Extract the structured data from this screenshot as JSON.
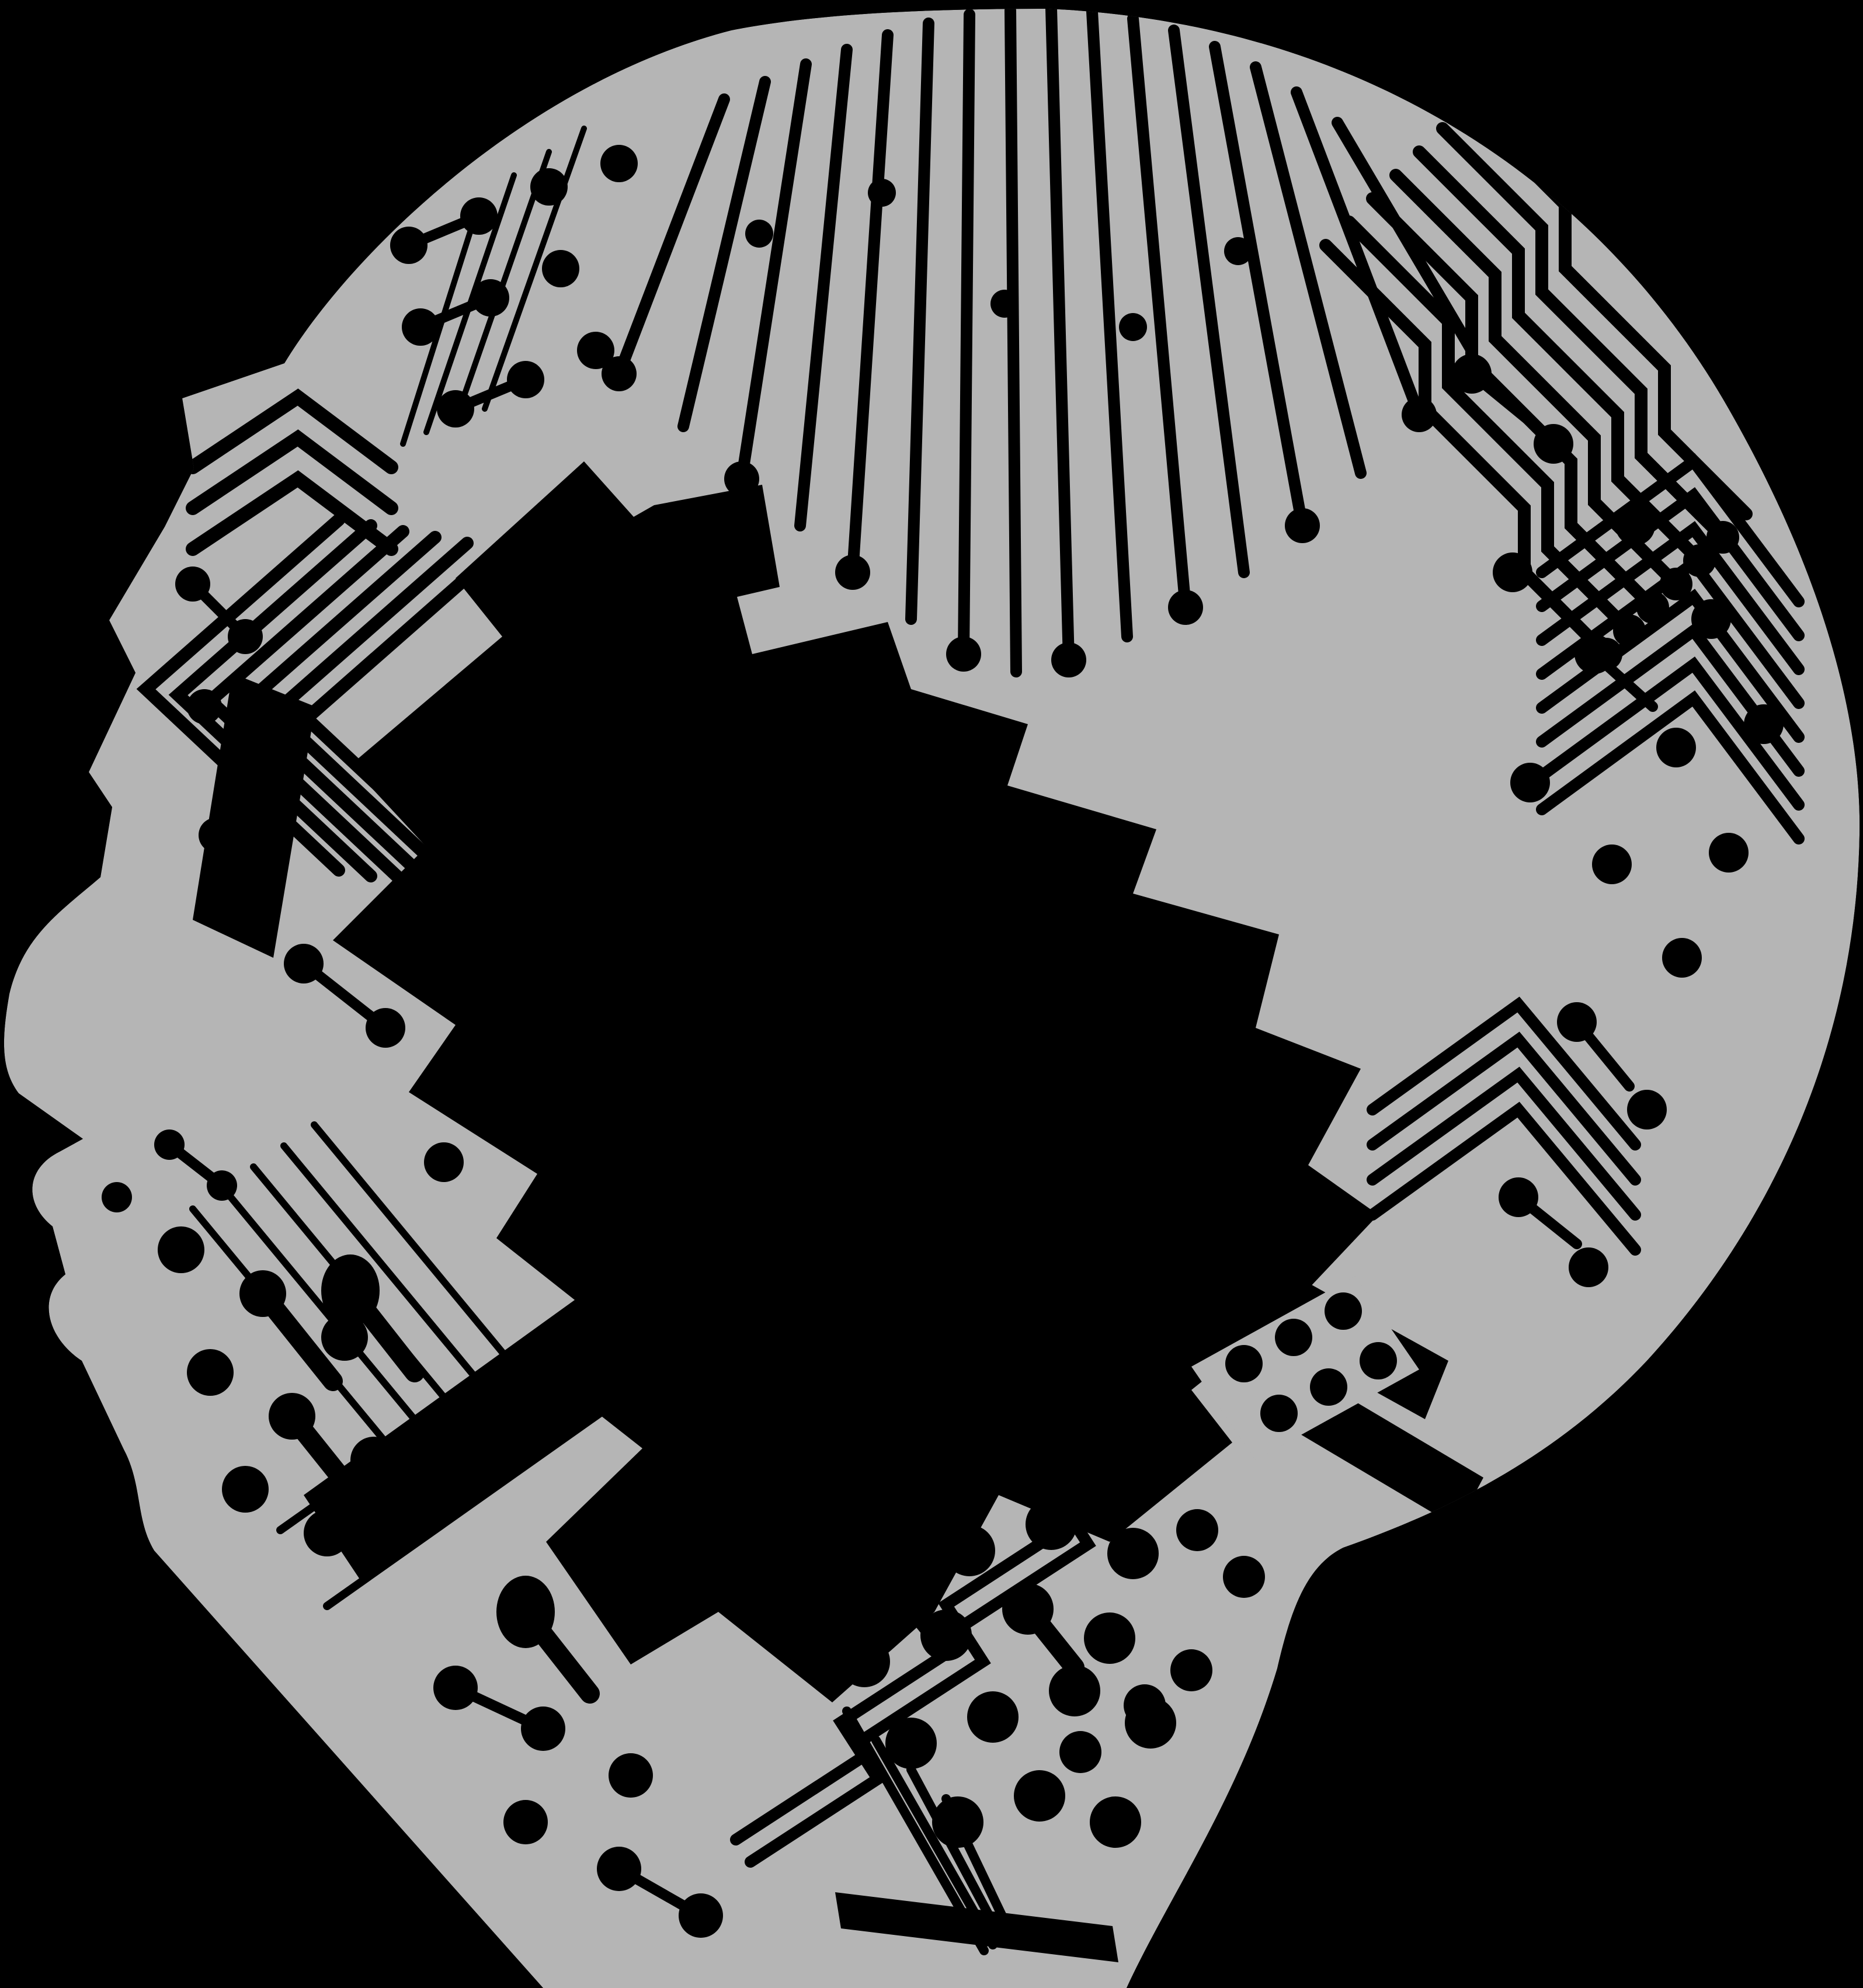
{
  "meta": {
    "title": "Circuit board head",
    "description": "Monochrome illustration of a human head in left-facing profile formed from a printed circuit board pattern of traces, pads and vias on a black background; a large black chip-shaped void occupies the centre of the head."
  },
  "colors": {
    "background": "#000000",
    "board": "#b5b5b5",
    "ink": "#000000"
  }
}
